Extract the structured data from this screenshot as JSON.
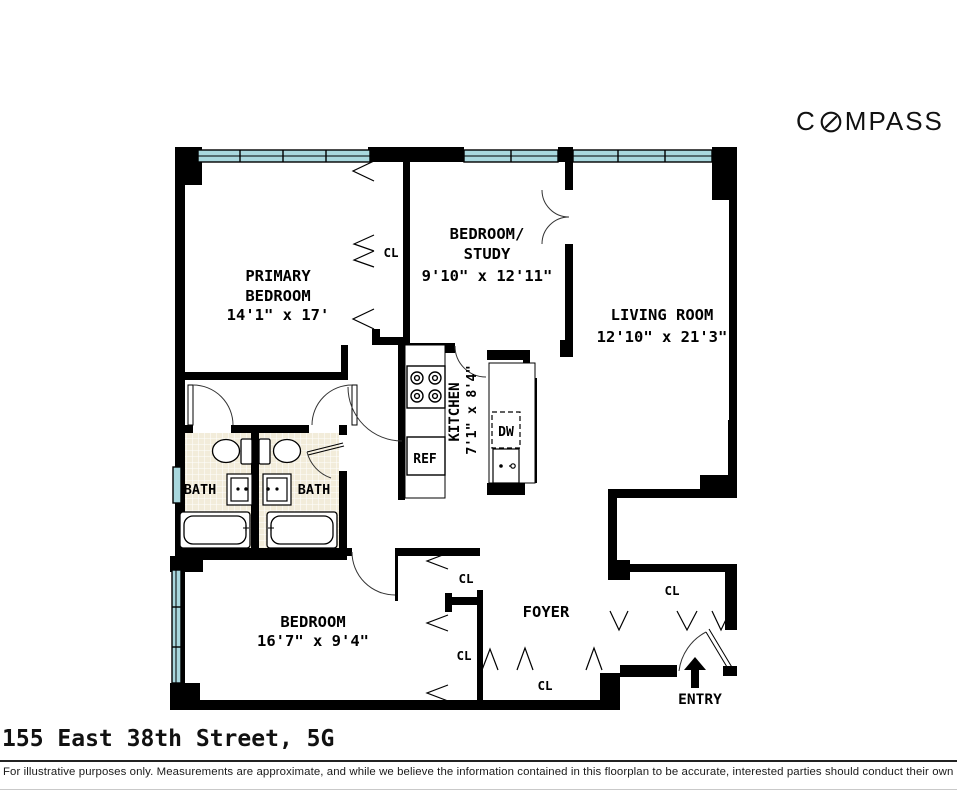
{
  "logo": {
    "first": "C",
    "rest": "MPASS",
    "name": "COMPASS"
  },
  "title": "155 East 38th Street, 5G",
  "disclaimer": "For illustrative purposes only.  Measurements are approximate, and while we believe the information contained in this floorplan to be accurate, interested parties should conduct their own inquiries.",
  "rooms": {
    "primary_bedroom": {
      "line1": "PRIMARY",
      "line2": "BEDROOM",
      "dims": "14'1\" x 17'"
    },
    "bedroom_study": {
      "line1": "BEDROOM/",
      "line2": "STUDY",
      "dims": "9'10\" x 12'11\""
    },
    "living_room": {
      "name": "LIVING ROOM",
      "dims": "12'10\" x 21'3\""
    },
    "kitchen": {
      "name": "KITCHEN",
      "dims": "7'1\" x 8'4\""
    },
    "bedroom": {
      "name": "BEDROOM",
      "dims": "16'7\" x 9'4\""
    },
    "foyer": {
      "name": "FOYER"
    },
    "bath": {
      "name": "BATH"
    },
    "entry": {
      "name": "ENTRY"
    }
  },
  "labels": {
    "closet": "CL",
    "refrigerator": "REF",
    "dishwasher": "DW"
  },
  "colors": {
    "wall": "#000000",
    "window": "#a9d8de",
    "bath_tile": "#f2ecda",
    "text": "#000000"
  }
}
